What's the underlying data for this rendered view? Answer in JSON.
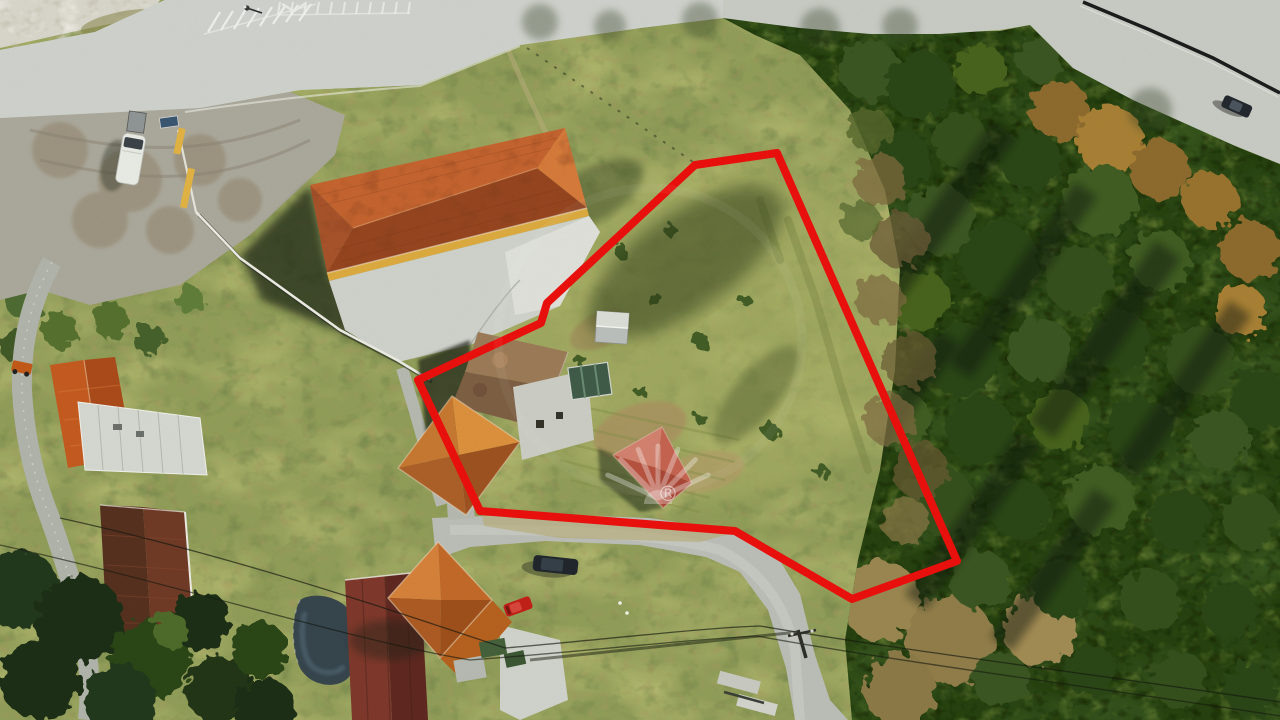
{
  "scene": {
    "kind": "aerial-drone-photograph",
    "subject": "rural land plot for sale outlined in red"
  },
  "boundary": {
    "color": "#e8100c",
    "stroke_width": 8,
    "vertices": [
      [
        777,
        153
      ],
      [
        695,
        165
      ],
      [
        547,
        303
      ],
      [
        541,
        323
      ],
      [
        418,
        380
      ],
      [
        480,
        511
      ],
      [
        735,
        531
      ],
      [
        852,
        599
      ],
      [
        957,
        561
      ]
    ]
  },
  "watermark": {
    "registered_symbol": "®",
    "color": "#ffffff"
  }
}
